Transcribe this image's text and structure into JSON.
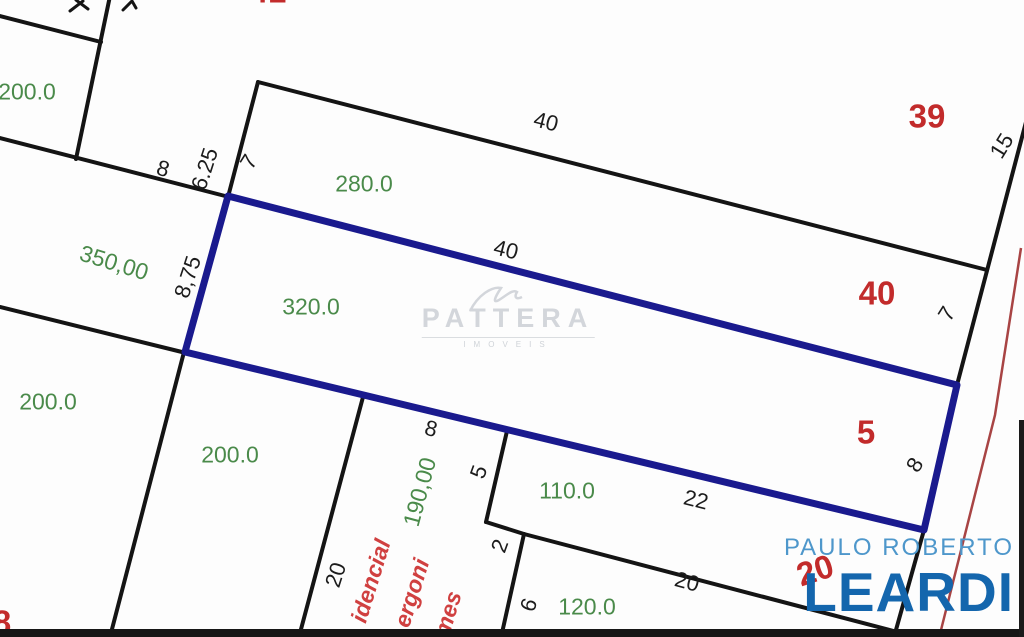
{
  "plan": {
    "description_labels_note": "land plot plan with lot areas (green), lot numbers (red), edge dimensions (black) and a highlighted lot outlined in navy blue"
  },
  "watermark": {
    "name": "PATTERA",
    "subtext": "IMOVEIS"
  },
  "logo": {
    "line1": "PAULO ROBERTO",
    "line2": "LEARDI"
  },
  "colors": {
    "highlight_blue": "#1a1a8e",
    "line_black": "#141414",
    "street_line_red": "#a84444",
    "area_green": "#4a8a4a",
    "lot_red": "#c22b2b",
    "street_text_red": "#d04040",
    "logo_light_blue": "#4e97cb",
    "logo_dark_blue": "#1466ad",
    "watermark_gray": "#d3d6db"
  },
  "labels": [
    {
      "name": "area-topleft-200",
      "type": "area",
      "text": "200.0",
      "x": 27,
      "y": 92,
      "rot": 0
    },
    {
      "name": "area-350",
      "type": "area",
      "text": "350,00",
      "x": 114,
      "y": 263,
      "rot": 17
    },
    {
      "name": "area-280",
      "type": "area",
      "text": "280.0",
      "x": 364,
      "y": 184,
      "rot": 0
    },
    {
      "name": "area-320",
      "type": "area",
      "text": "320.0",
      "x": 311,
      "y": 307,
      "rot": 0
    },
    {
      "name": "area-left-200",
      "type": "area",
      "text": "200.0",
      "x": 48,
      "y": 402,
      "rot": 0
    },
    {
      "name": "area-mid-200",
      "type": "area",
      "text": "200.0",
      "x": 230,
      "y": 455,
      "rot": 0
    },
    {
      "name": "area-110",
      "type": "area",
      "text": "110.0",
      "x": 567,
      "y": 491,
      "rot": 0
    },
    {
      "name": "area-190",
      "type": "area",
      "text": "190,00",
      "x": 420,
      "y": 492,
      "rot": -75
    },
    {
      "name": "area-120",
      "type": "area",
      "text": "120.0",
      "x": 587,
      "y": 607,
      "rot": 0
    },
    {
      "name": "dim-8-upperleft",
      "type": "dim",
      "text": "8",
      "x": 163,
      "y": 169,
      "rot": 16
    },
    {
      "name": "dim-6-25",
      "type": "dim",
      "text": "6.25",
      "x": 205,
      "y": 169,
      "rot": -72
    },
    {
      "name": "dim-7-left",
      "type": "dim",
      "text": "7",
      "x": 249,
      "y": 162,
      "rot": -58
    },
    {
      "name": "dim-40-top",
      "type": "dim",
      "text": "40",
      "x": 546,
      "y": 122,
      "rot": 14
    },
    {
      "name": "dim-40-mid",
      "type": "dim",
      "text": "40",
      "x": 506,
      "y": 250,
      "rot": 14
    },
    {
      "name": "dim-8-75",
      "type": "dim",
      "text": "8,75",
      "x": 188,
      "y": 277,
      "rot": -72
    },
    {
      "name": "dim-15",
      "type": "dim",
      "text": "15",
      "x": 1002,
      "y": 146,
      "rot": -58
    },
    {
      "name": "dim-7-right",
      "type": "dim",
      "text": "7",
      "x": 947,
      "y": 314,
      "rot": -58
    },
    {
      "name": "dim-8-right",
      "type": "dim",
      "text": "8",
      "x": 915,
      "y": 465,
      "rot": -58
    },
    {
      "name": "dim-8-frontage",
      "type": "dim",
      "text": "8",
      "x": 431,
      "y": 429,
      "rot": 14
    },
    {
      "name": "dim-5",
      "type": "dim",
      "text": "5",
      "x": 479,
      "y": 472,
      "rot": -70
    },
    {
      "name": "dim-22",
      "type": "dim",
      "text": "22",
      "x": 696,
      "y": 500,
      "rot": 14
    },
    {
      "name": "dim-2",
      "type": "dim",
      "text": "2",
      "x": 500,
      "y": 546,
      "rot": -70
    },
    {
      "name": "dim-20-left",
      "type": "dim",
      "text": "20",
      "x": 336,
      "y": 575,
      "rot": -72
    },
    {
      "name": "dim-20-bottom",
      "type": "dim",
      "text": "20",
      "x": 687,
      "y": 582,
      "rot": 15
    },
    {
      "name": "dim-6",
      "type": "dim",
      "text": "6",
      "x": 529,
      "y": 605,
      "rot": -70
    },
    {
      "name": "lot-39",
      "type": "lot",
      "text": "39",
      "x": 927,
      "y": 116,
      "rot": 0
    },
    {
      "name": "lot-40",
      "type": "lot",
      "text": "40",
      "x": 877,
      "y": 293,
      "rot": 0
    },
    {
      "name": "lot-5",
      "type": "lot",
      "text": "5",
      "x": 866,
      "y": 432,
      "rot": 0
    },
    {
      "name": "lot-20",
      "type": "lot",
      "text": "20",
      "x": 815,
      "y": 570,
      "rot": -18
    },
    {
      "name": "lot-top-partial",
      "type": "lot",
      "text": "41",
      "x": 268,
      "y": -9,
      "rot": 0
    },
    {
      "name": "lot-left-partial",
      "type": "lot",
      "text": "8",
      "x": 2,
      "y": 622,
      "rot": 0
    },
    {
      "name": "street-idencial",
      "type": "street",
      "text": "idencial",
      "x": 371,
      "y": 581,
      "rot": -73
    },
    {
      "name": "street-ergoni",
      "type": "street",
      "text": "ergoni",
      "x": 412,
      "y": 593,
      "rot": -73
    },
    {
      "name": "street-mes",
      "type": "street",
      "text": "mes",
      "x": 448,
      "y": 614,
      "rot": -73
    }
  ]
}
